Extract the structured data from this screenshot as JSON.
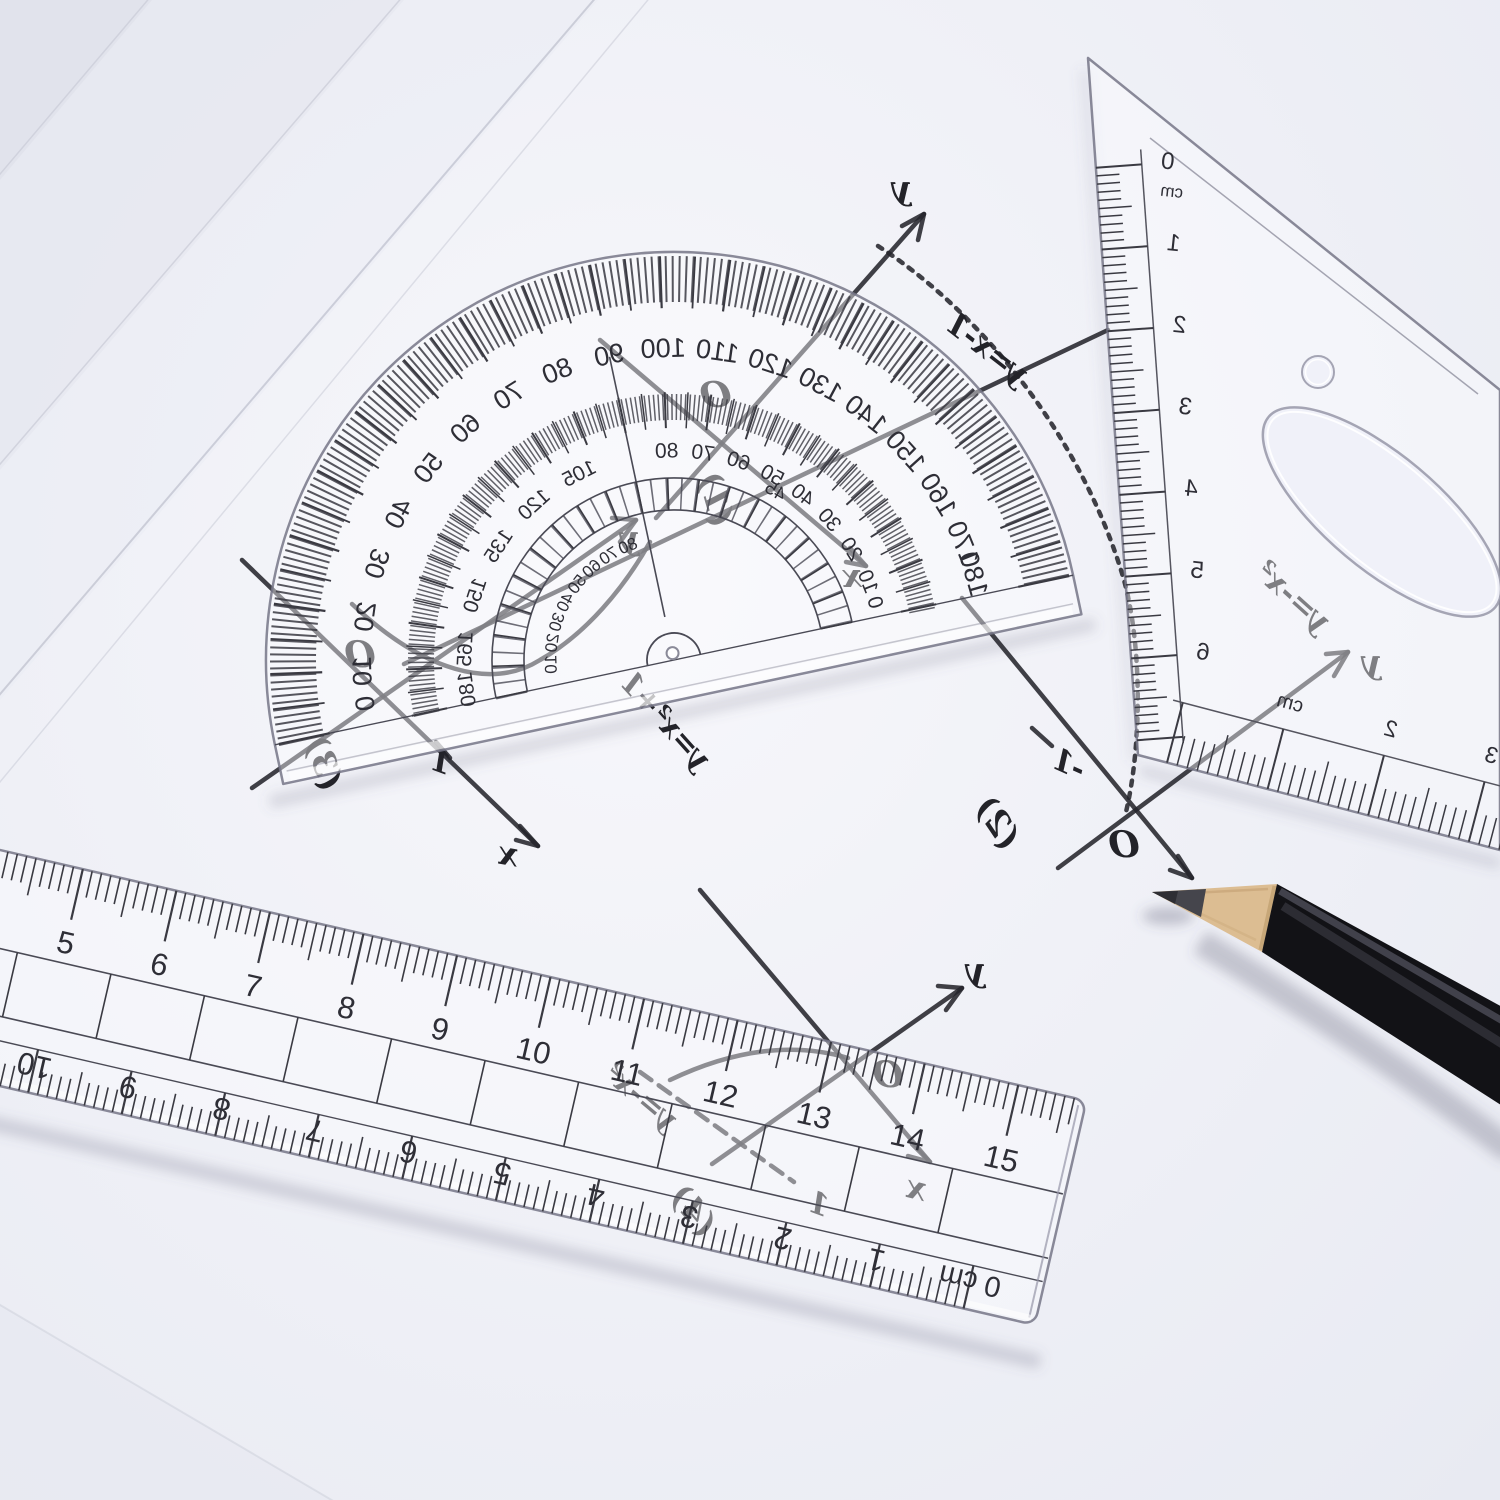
{
  "protractor": {
    "row_a": [
      {
        "deg": 4,
        "label": "0"
      },
      {
        "deg": 10,
        "label": "10"
      },
      {
        "deg": 20,
        "label": "20"
      },
      {
        "deg": 30,
        "label": "30"
      },
      {
        "deg": 40,
        "label": "40"
      },
      {
        "deg": 50,
        "label": "50"
      },
      {
        "deg": 60,
        "label": "60"
      },
      {
        "deg": 70,
        "label": "70"
      },
      {
        "deg": 80,
        "label": "80"
      },
      {
        "deg": 90,
        "label": "90"
      },
      {
        "deg": 100,
        "label": "100"
      },
      {
        "deg": 110,
        "label": "110"
      },
      {
        "deg": 120,
        "label": "120"
      },
      {
        "deg": 130,
        "label": "130"
      },
      {
        "deg": 140,
        "label": "140"
      },
      {
        "deg": 150,
        "label": "150"
      },
      {
        "deg": 160,
        "label": "160"
      },
      {
        "deg": 170,
        "label": "170"
      },
      {
        "deg": 176,
        "label": "180"
      }
    ],
    "row_b": [
      {
        "deg": 4,
        "label": "180"
      },
      {
        "deg": 15,
        "label": "165"
      },
      {
        "deg": 30,
        "label": "150"
      },
      {
        "deg": 45,
        "label": "135"
      },
      {
        "deg": 60,
        "label": "120"
      },
      {
        "deg": 75,
        "label": "105"
      },
      {
        "deg": 100,
        "label": "80"
      },
      {
        "deg": 110,
        "label": "70"
      },
      {
        "deg": 120,
        "label": "60"
      },
      {
        "deg": 130,
        "label": "50"
      },
      {
        "deg": 140,
        "label": "40"
      },
      {
        "deg": 150,
        "label": "30"
      },
      {
        "deg": 160,
        "label": "20"
      },
      {
        "deg": 170,
        "label": "10"
      },
      {
        "deg": 176,
        "label": "0"
      }
    ],
    "row_band": [
      {
        "deg": 10,
        "label": "10"
      },
      {
        "deg": 20,
        "label": "20"
      },
      {
        "deg": 30,
        "label": "30"
      },
      {
        "deg": 40,
        "label": "40"
      },
      {
        "deg": 50,
        "label": "50"
      },
      {
        "deg": 60,
        "label": "60"
      },
      {
        "deg": 70,
        "label": "70"
      },
      {
        "deg": 80,
        "label": "80"
      },
      {
        "deg": 133,
        "label": "45"
      }
    ]
  },
  "triangle": {
    "left_scale": {
      "zero": "0",
      "unit": "cm",
      "numbers": [
        "1",
        "2",
        "3",
        "4",
        "5",
        "6"
      ]
    },
    "bottom_scale": {
      "unit": "cm",
      "numbers": [
        "2",
        "3"
      ]
    }
  },
  "ruler": {
    "top_numbers": [
      "5",
      "6",
      "7",
      "8",
      "9",
      "10",
      "11",
      "12",
      "13",
      "14",
      "15"
    ],
    "bottom_numbers": [
      "10",
      "9",
      "8",
      "7",
      "6",
      "5",
      "4",
      "3",
      "2",
      "1"
    ],
    "bottom_zero": "0 cm"
  },
  "graphs": [
    {
      "id": "(1)",
      "equation": "y=x-1",
      "origin": "O",
      "x_label": "x",
      "y_label": "y"
    },
    {
      "id": "(2)",
      "equation": "y=-x²",
      "origin": "O",
      "y_label": "y",
      "neg_one": "-1"
    },
    {
      "id": "(3)",
      "equation": "y=x²+1",
      "origin": "O",
      "x_label": "x",
      "y_label": "y",
      "one": "1"
    },
    {
      "id": "(4)",
      "equation": "y=-x²",
      "origin": "O",
      "x_label": "x",
      "y_label": "y",
      "one": "1"
    }
  ]
}
